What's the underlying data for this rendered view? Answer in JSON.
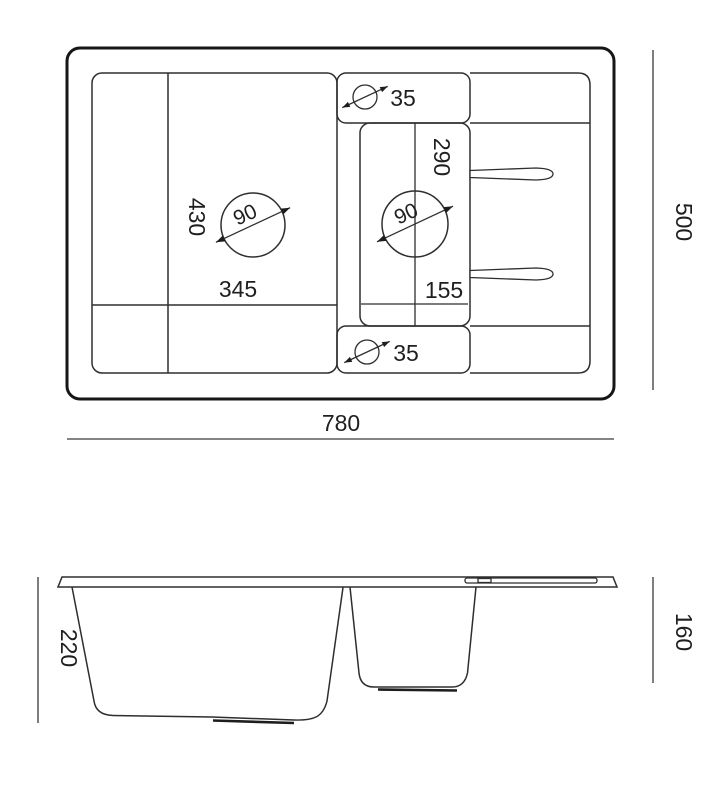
{
  "top_view": {
    "overall_width": "780",
    "overall_depth": "500",
    "main_bowl": {
      "width": "345",
      "depth": "430",
      "drain_diameter": "90"
    },
    "small_bowl": {
      "center_offset": "155",
      "depth": "290",
      "drain_diameter": "90"
    },
    "tap_hole_top": "35",
    "tap_hole_bottom": "35"
  },
  "side_view": {
    "main_bowl_height": "220",
    "small_bowl_height": "160"
  }
}
